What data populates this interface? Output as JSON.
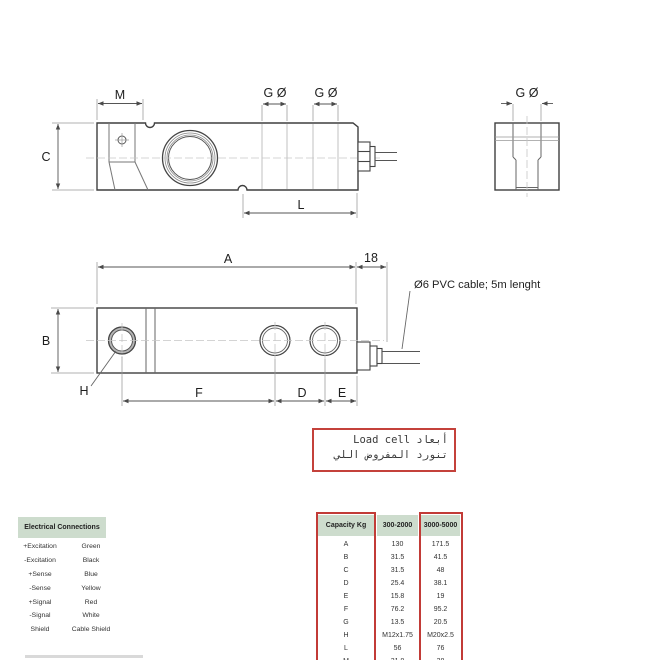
{
  "drawing": {
    "side_view": {
      "m": "M",
      "g1": "G Ø",
      "g2": "G Ø",
      "c": "C",
      "l": "L"
    },
    "end_view": {
      "g": "G Ø"
    },
    "plan_view": {
      "a": "A",
      "offset": "18",
      "b": "B",
      "h": "H",
      "f": "F",
      "d": "D",
      "e": "E"
    },
    "cable_note": "Ø6 PVC cable; 5m lenght"
  },
  "note_box": {
    "line1": "أبعاد Load cell",
    "line2": "تنورد المفروض اللي"
  },
  "electrical_table": {
    "title": "Electrical Connections",
    "rows": [
      {
        "signal": "+Excitation",
        "wire": "Green"
      },
      {
        "signal": "-Excitation",
        "wire": "Black"
      },
      {
        "signal": "+Sense",
        "wire": "Blue"
      },
      {
        "signal": "-Sense",
        "wire": "Yellow"
      },
      {
        "signal": "+Signal",
        "wire": "Red"
      },
      {
        "signal": "-Signal",
        "wire": "White"
      },
      {
        "signal": "Shield",
        "wire": "Cable Shield"
      }
    ]
  },
  "capacity_table": {
    "headers": [
      "Capacity Kg",
      "300-2000",
      "3000-5000"
    ],
    "rows": [
      [
        "A",
        "130",
        "171.5"
      ],
      [
        "B",
        "31.5",
        "41.5"
      ],
      [
        "C",
        "31.5",
        "48"
      ],
      [
        "D",
        "25.4",
        "38.1"
      ],
      [
        "E",
        "15.8",
        "19"
      ],
      [
        "F",
        "76.2",
        "95.2"
      ],
      [
        "G",
        "13.5",
        "20.5"
      ],
      [
        "H",
        "M12x1.75",
        "M20x2.5"
      ],
      [
        "L",
        "56",
        "76"
      ],
      [
        "M",
        "31.8",
        "38"
      ]
    ]
  },
  "colors": {
    "table_header_bg": "#cddccd",
    "highlight_red": "#c23b37",
    "outline": "#3f3f3f"
  }
}
